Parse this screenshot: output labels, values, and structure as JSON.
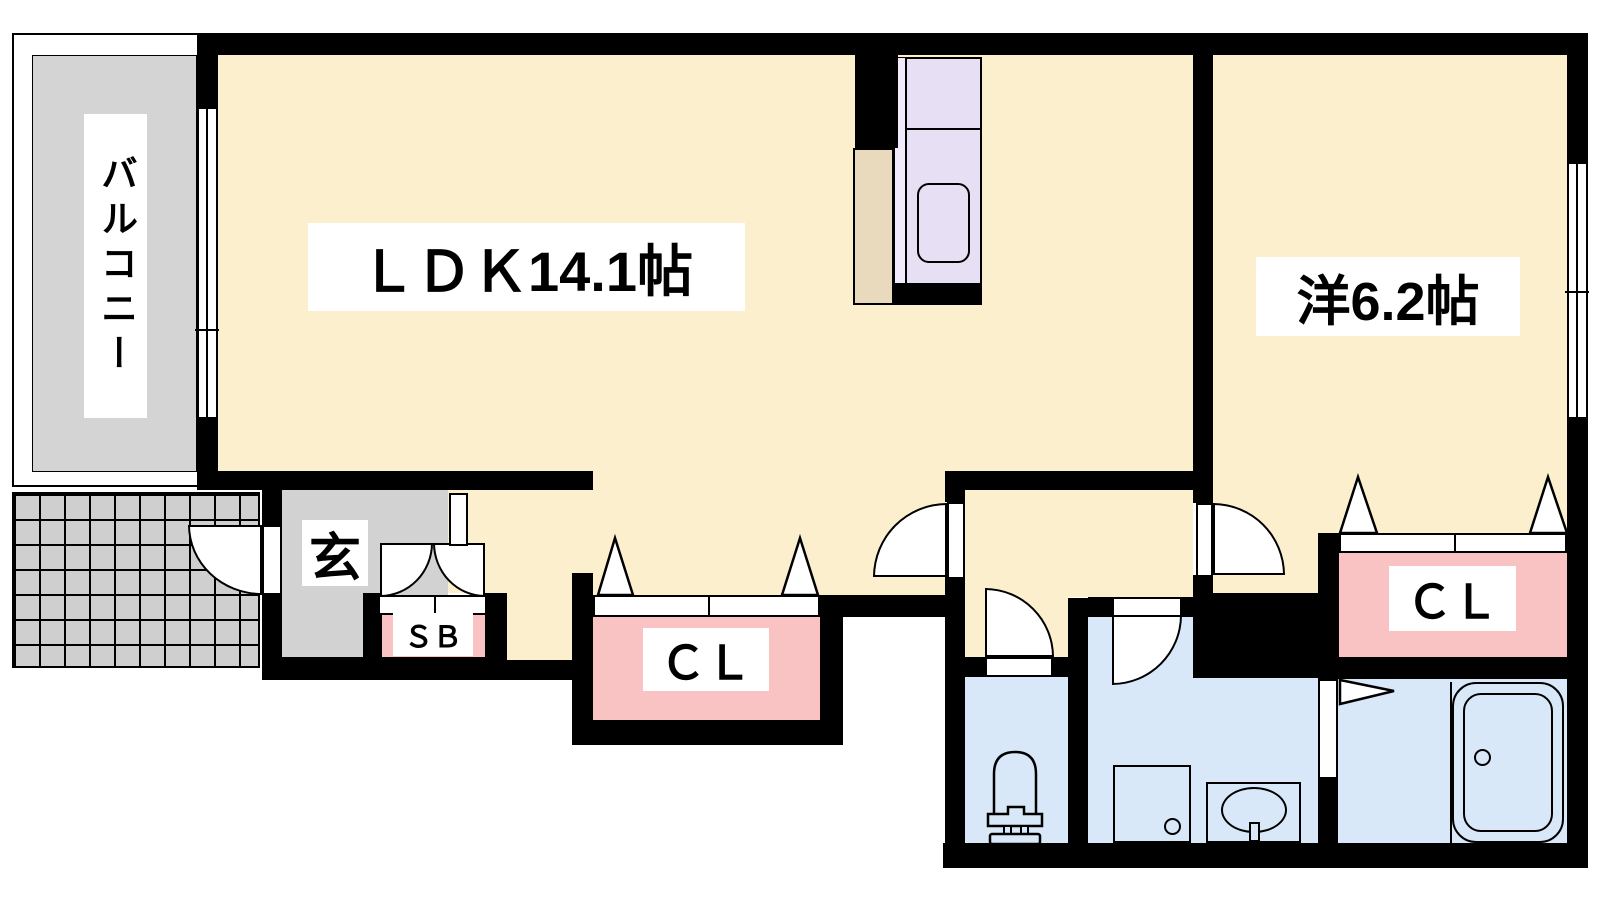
{
  "plan_title": "apartment-floor-plan",
  "rooms": {
    "balcony": {
      "label": "バルコニー"
    },
    "ldk": {
      "label": "ＬＤＫ14.1帖"
    },
    "western_room": {
      "label": "洋6.2帖"
    },
    "entrance": {
      "label": "玄"
    },
    "shoe_box": {
      "label": "ＳＢ"
    },
    "closet_hall": {
      "label": "ＣＬ"
    },
    "closet_bedroom": {
      "label": "ＣＬ"
    }
  },
  "fixtures": [
    "kitchen-counter",
    "kitchen-sink",
    "refrigerator-space",
    "toilet",
    "washing-machine-pan",
    "vanity-sink",
    "bathtub"
  ],
  "colors": {
    "floor_cream": "#FBEFCE",
    "wall_black": "#000000",
    "balcony_gray": "#D4D4D4",
    "tile_gray": "#CFCFCF",
    "entrance_gray": "#D2D2D2",
    "closet_pink": "#F9C3C3",
    "wet_area_blue": "#D9E8F8",
    "kitchen_purple": "#E7DFF4",
    "refrigerator_beige": "#EADABD",
    "label_bg": "#FFFFFF"
  }
}
